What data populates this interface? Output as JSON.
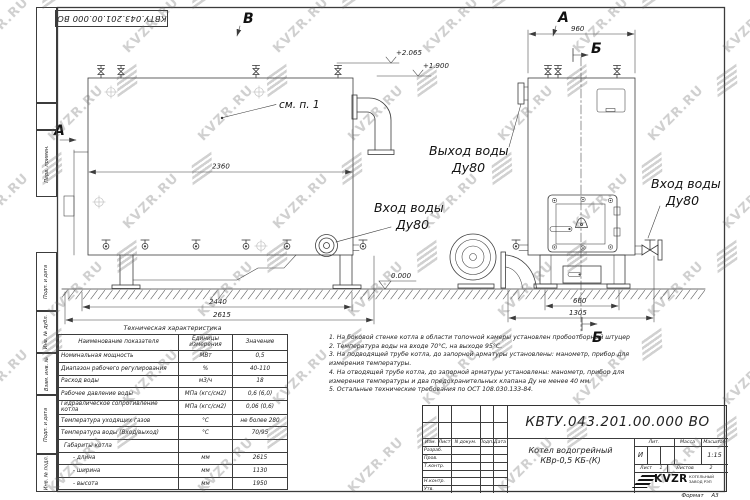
{
  "watermark": {
    "text": "KVZR.RU"
  },
  "frame": {
    "top_number": "КВТУ.043.201.00.000 ВО",
    "margin_labels": [
      "Перв. примен.",
      "Подп. и дата",
      "Инв. № дубл.",
      "Взам. инв. №",
      "Подп. и дата",
      "Инв. № подл."
    ]
  },
  "views": {
    "marker_b_top": "В",
    "marker_a_left": "А",
    "marker_a_right": "А",
    "section_b_top": "Б",
    "section_b_bottom": "Б",
    "see_note": "см. п. 1",
    "level_top": "+2.065",
    "level_mid": "+1.900",
    "level_zero": "0.000",
    "dim_left_body": "2360",
    "dim_left_support": "2440",
    "dim_left_total": "2615",
    "dim_front_width": "960",
    "dim_front_support": "660",
    "dim_front_total": "1305",
    "outlet_label": "Выход воды",
    "outlet_dn": "Ду80",
    "inlet_left_label": "Вход воды",
    "inlet_left_dn": "Ду80",
    "inlet_right_label": "Вход воды",
    "inlet_right_dn": "Ду80"
  },
  "spec_table": {
    "title": "Техническая характеристика",
    "headers": [
      "Наименование показателя",
      "Единицы измерения",
      "Значение"
    ],
    "rows": [
      [
        "Номинальная мощность",
        "МВт",
        "0,5"
      ],
      [
        "Диапазон рабочего регулирования",
        "%",
        "40-110"
      ],
      [
        "Расход воды",
        "м3/ч",
        "18"
      ],
      [
        "Рабочее давление воды",
        "МПа (кгс/см2)",
        "0,6 (6,0)"
      ],
      [
        "Гидравлическое сопротивление котла",
        "МПа (кгс/см2)",
        "0,06 (0,6)"
      ],
      [
        "Температура уходящих газов",
        "°С",
        "не более 280"
      ],
      [
        "Температура воды (Вход/выход)",
        "°С",
        "70/95"
      ],
      [
        "Габариты котла",
        "",
        ""
      ],
      [
        "- длина",
        "мм",
        "2615"
      ],
      [
        "- ширина",
        "мм",
        "1130"
      ],
      [
        "- высота",
        "мм",
        "1950"
      ]
    ]
  },
  "notes": {
    "lines": [
      "1.  На боковой стенке котла в области топочной камеры установлен пробоотборный штуцер",
      "2.  Температура воды на входе 70°С, на выходе 95°С.",
      "3.  На подводящей трубе котла, до запорной арматуры установлены: манометр, прибор для",
      "измерения температуры.",
      "4.  На отводящей трубе котла, до запорной арматуры установлены: манометр, прибор для",
      "измерения температуры и два предохранительных клапана Ду не менее 40 мм.",
      "5.  Остальные технические требования по ОСТ 108.030.133-84."
    ]
  },
  "title_block": {
    "doc_number": "КВТУ.043.201.00.000 ВО",
    "col_izm": "Изм.",
    "col_list": "Лист",
    "col_doc": "N докум.",
    "col_podp": "Подп.",
    "col_data": "Дата",
    "row_razrab": "Разраб.",
    "row_prov": "Пров.",
    "row_tkontr": "Т.контр.",
    "row_nkontr": "Н.контр.",
    "row_utv": "Утв.",
    "product_line1": "Котел водогрейный",
    "product_line2": "КВр-0,5  КБ-(К)",
    "lit_label": "Лит.",
    "lit_value": "И",
    "mass_label": "Масса",
    "scale_label": "Масштаб",
    "scale_value": "1:15",
    "sheet_label": "Лист",
    "sheet_value": "1",
    "sheets_label": "Листов",
    "sheets_value": "2",
    "logo_text": "KVZR",
    "company_line1": "КОТЕЛЬНЫЙ",
    "company_line2": "ЗАВОД РЭП",
    "format_label": "Формат",
    "format_value": "А3"
  }
}
